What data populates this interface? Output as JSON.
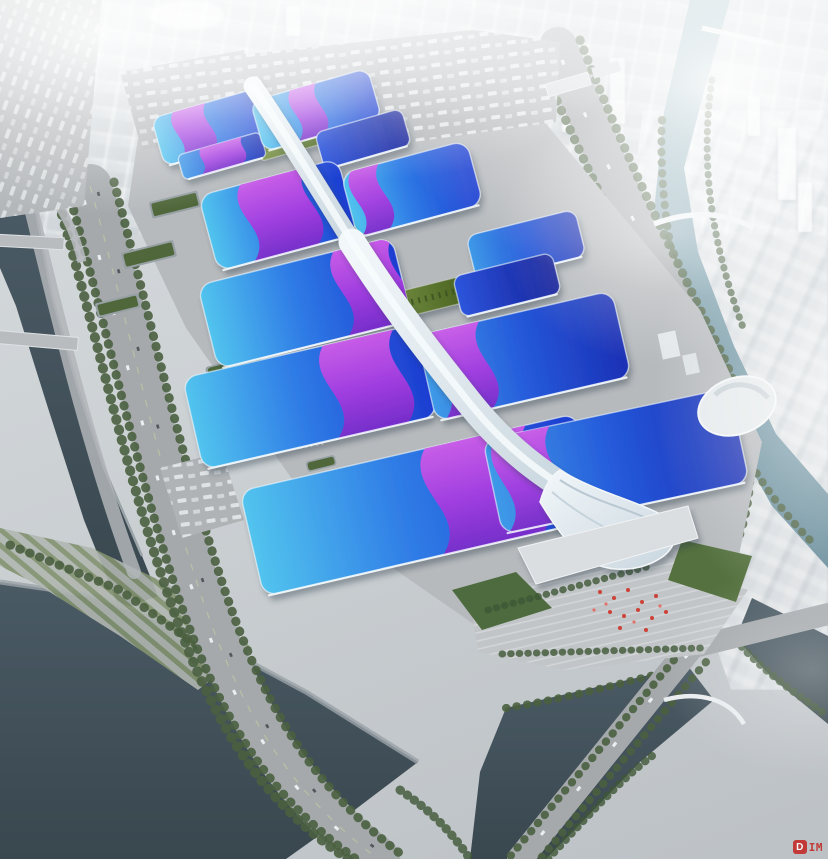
{
  "watermark": {
    "badge_letter": "D",
    "suffix_text": "IM"
  },
  "palette": {
    "road": "#a5a9ac",
    "tree-green": "#4a5f3f",
    "accent-red": "#c4231f",
    "roof-cyan": "#4cc0ec",
    "roof-blue": "#2457d8",
    "roof-deep": "#141f96",
    "ribbon-light": "#d55ce8",
    "ribbon-dark": "#7c2ac8",
    "water-dark": "#42525c",
    "water-teal": "#7ba3b0",
    "spine-silver": "#e9eff3",
    "lawn-green": "#4e6b3f"
  },
  "complex": {
    "halls": [
      {
        "name": "green-courtyard-north",
        "cx": 295,
        "cy": 141,
        "w": 76,
        "h": 20,
        "a": -16,
        "shade": "Green",
        "ribbons": []
      },
      {
        "name": "green-courtyard-mid",
        "cx": 424,
        "cy": 299,
        "w": 94,
        "h": 26,
        "a": -14,
        "shade": "Green",
        "ribbons": []
      },
      {
        "name": "hall-nw",
        "cx": 212,
        "cy": 127,
        "w": 112,
        "h": 50,
        "a": -16,
        "shade": "A",
        "ribbons": [
          {
            "at": 0.2,
            "w": 0.3
          }
        ]
      },
      {
        "name": "hall-nw-annex",
        "cx": 222,
        "cy": 156,
        "w": 86,
        "h": 26,
        "a": -16,
        "shade": "B",
        "ribbons": [
          {
            "at": 0.28,
            "w": 0.5
          }
        ]
      },
      {
        "name": "hall-ne",
        "cx": 316,
        "cy": 110,
        "w": 122,
        "h": 52,
        "a": -16,
        "shade": "A",
        "ribbons": [
          {
            "at": 0.34,
            "w": 0.22
          }
        ]
      },
      {
        "name": "hall-ne-annex",
        "cx": 363,
        "cy": 139,
        "w": 90,
        "h": 38,
        "a": -16,
        "shade": "Deep",
        "ribbons": []
      },
      {
        "name": "hall-w2",
        "cx": 278,
        "cy": 215,
        "w": 144,
        "h": 78,
        "a": -15,
        "shade": "A",
        "ribbons": [
          {
            "at": 0.3,
            "w": 0.46
          }
        ]
      },
      {
        "name": "hall-e2",
        "cx": 412,
        "cy": 189,
        "w": 130,
        "h": 66,
        "a": -15,
        "shade": "A",
        "ribbons": [
          {
            "at": 0.08,
            "w": 0.22
          }
        ]
      },
      {
        "name": "hall-w3",
        "cx": 305,
        "cy": 303,
        "w": 200,
        "h": 86,
        "a": -14,
        "shade": "A",
        "ribbons": [
          {
            "at": 0.7,
            "w": 0.3
          }
        ]
      },
      {
        "name": "hall-e3",
        "cx": 526,
        "cy": 246,
        "w": 112,
        "h": 48,
        "a": -14,
        "shade": "B",
        "ribbons": []
      },
      {
        "name": "hall-e3-annex",
        "cx": 507,
        "cy": 285,
        "w": 102,
        "h": 42,
        "a": -14,
        "shade": "Deep",
        "ribbons": []
      },
      {
        "name": "hall-w4",
        "cx": 310,
        "cy": 397,
        "w": 240,
        "h": 94,
        "a": -13,
        "shade": "A",
        "ribbons": [
          {
            "at": 0.6,
            "w": 0.3
          }
        ]
      },
      {
        "name": "hall-e4",
        "cx": 524,
        "cy": 356,
        "w": 200,
        "h": 88,
        "a": -13,
        "shade": "B",
        "ribbons": [
          {
            "at": 0.08,
            "w": 0.24
          }
        ]
      },
      {
        "name": "hall-w5",
        "cx": 420,
        "cy": 505,
        "w": 345,
        "h": 108,
        "a": -13,
        "shade": "A",
        "ribbons": [
          {
            "at": 0.55,
            "w": 0.3
          }
        ]
      },
      {
        "name": "hall-e5",
        "cx": 616,
        "cy": 461,
        "w": 252,
        "h": 96,
        "a": -12,
        "shade": "B",
        "ribbons": [
          {
            "at": 0.05,
            "w": 0.22
          }
        ]
      }
    ]
  }
}
